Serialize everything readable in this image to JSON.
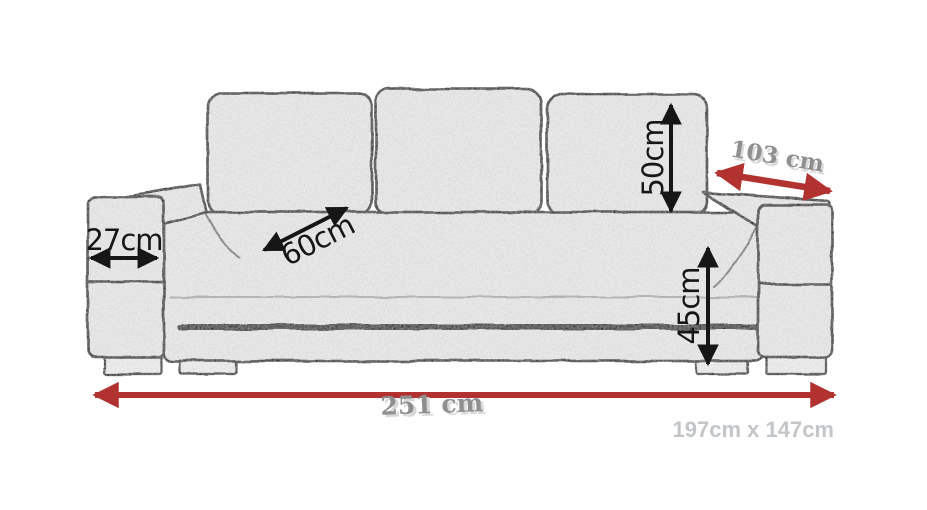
{
  "diagram": {
    "kind": "sofa-dimension-drawing",
    "labels": {
      "armrest_width": "27cm",
      "seat_depth": "60cm",
      "backrest_cushion_height": "50cm",
      "seat_height": "45cm",
      "sofa_depth": "103 cm",
      "sofa_width": "251 cm",
      "sleeping_area": "197cm x 147cm"
    },
    "colors": {
      "background": "#ffffff",
      "outline": "#161616",
      "fabric_fill": "#ededed",
      "dimension_black": "#161616",
      "dimension_red": "#b23230",
      "label_gray": "#8f8f8f",
      "label_shadow": "#d8d8d8",
      "sleeping_area_gray": "#c3c6c9"
    }
  }
}
